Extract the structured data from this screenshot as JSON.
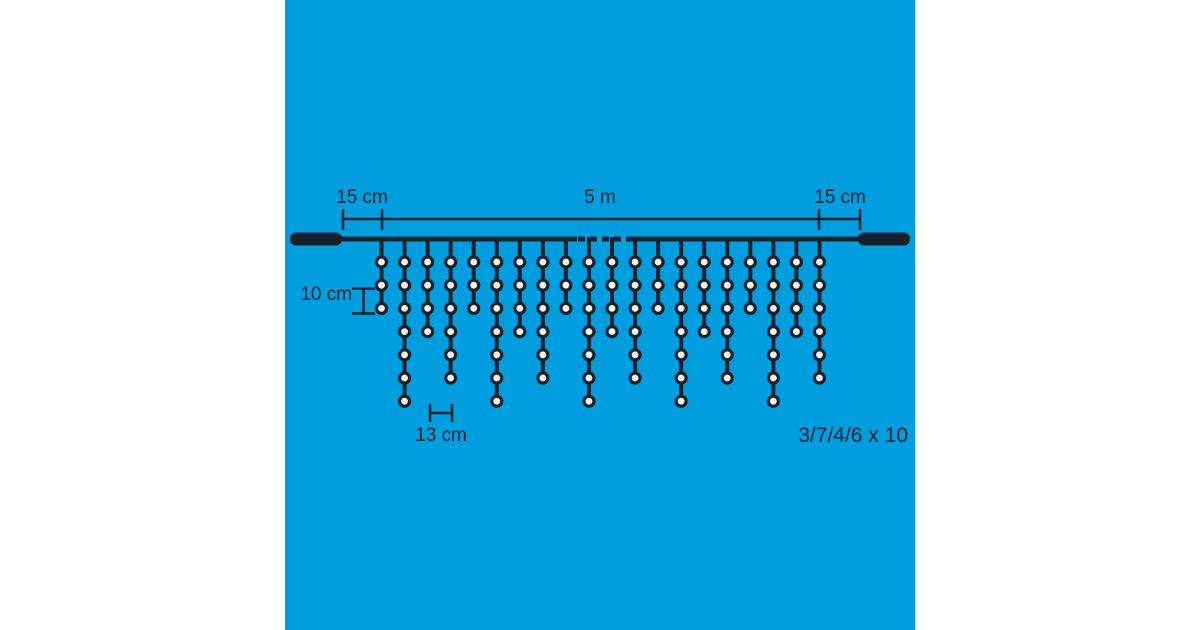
{
  "title": "Icicle light chain dimension diagram",
  "colors": {
    "page_background": "#ffffff",
    "panel_background": "#009DDF",
    "ink": "#15222E",
    "bulb_fill": "#F6F3ED"
  },
  "dimension_labels": {
    "lead_left": "15 cm",
    "main_span": "5 m",
    "lead_right": "15 cm",
    "bulb_vertical_spacing": "10 cm",
    "drop_horizontal_spacing": "13 cm"
  },
  "pattern_label": "3/7/4/6 x 10",
  "diagram": {
    "type": "icicle-light-string",
    "bulb_count_pattern": [
      3,
      7,
      4,
      6
    ],
    "pattern_repeats_shown": 5,
    "drops": [
      3,
      7,
      4,
      6,
      3,
      7,
      4,
      6,
      3,
      7,
      4,
      6,
      3,
      7,
      4,
      6,
      3,
      7,
      4,
      6
    ],
    "cable_break_shown_as_dashes": true
  }
}
